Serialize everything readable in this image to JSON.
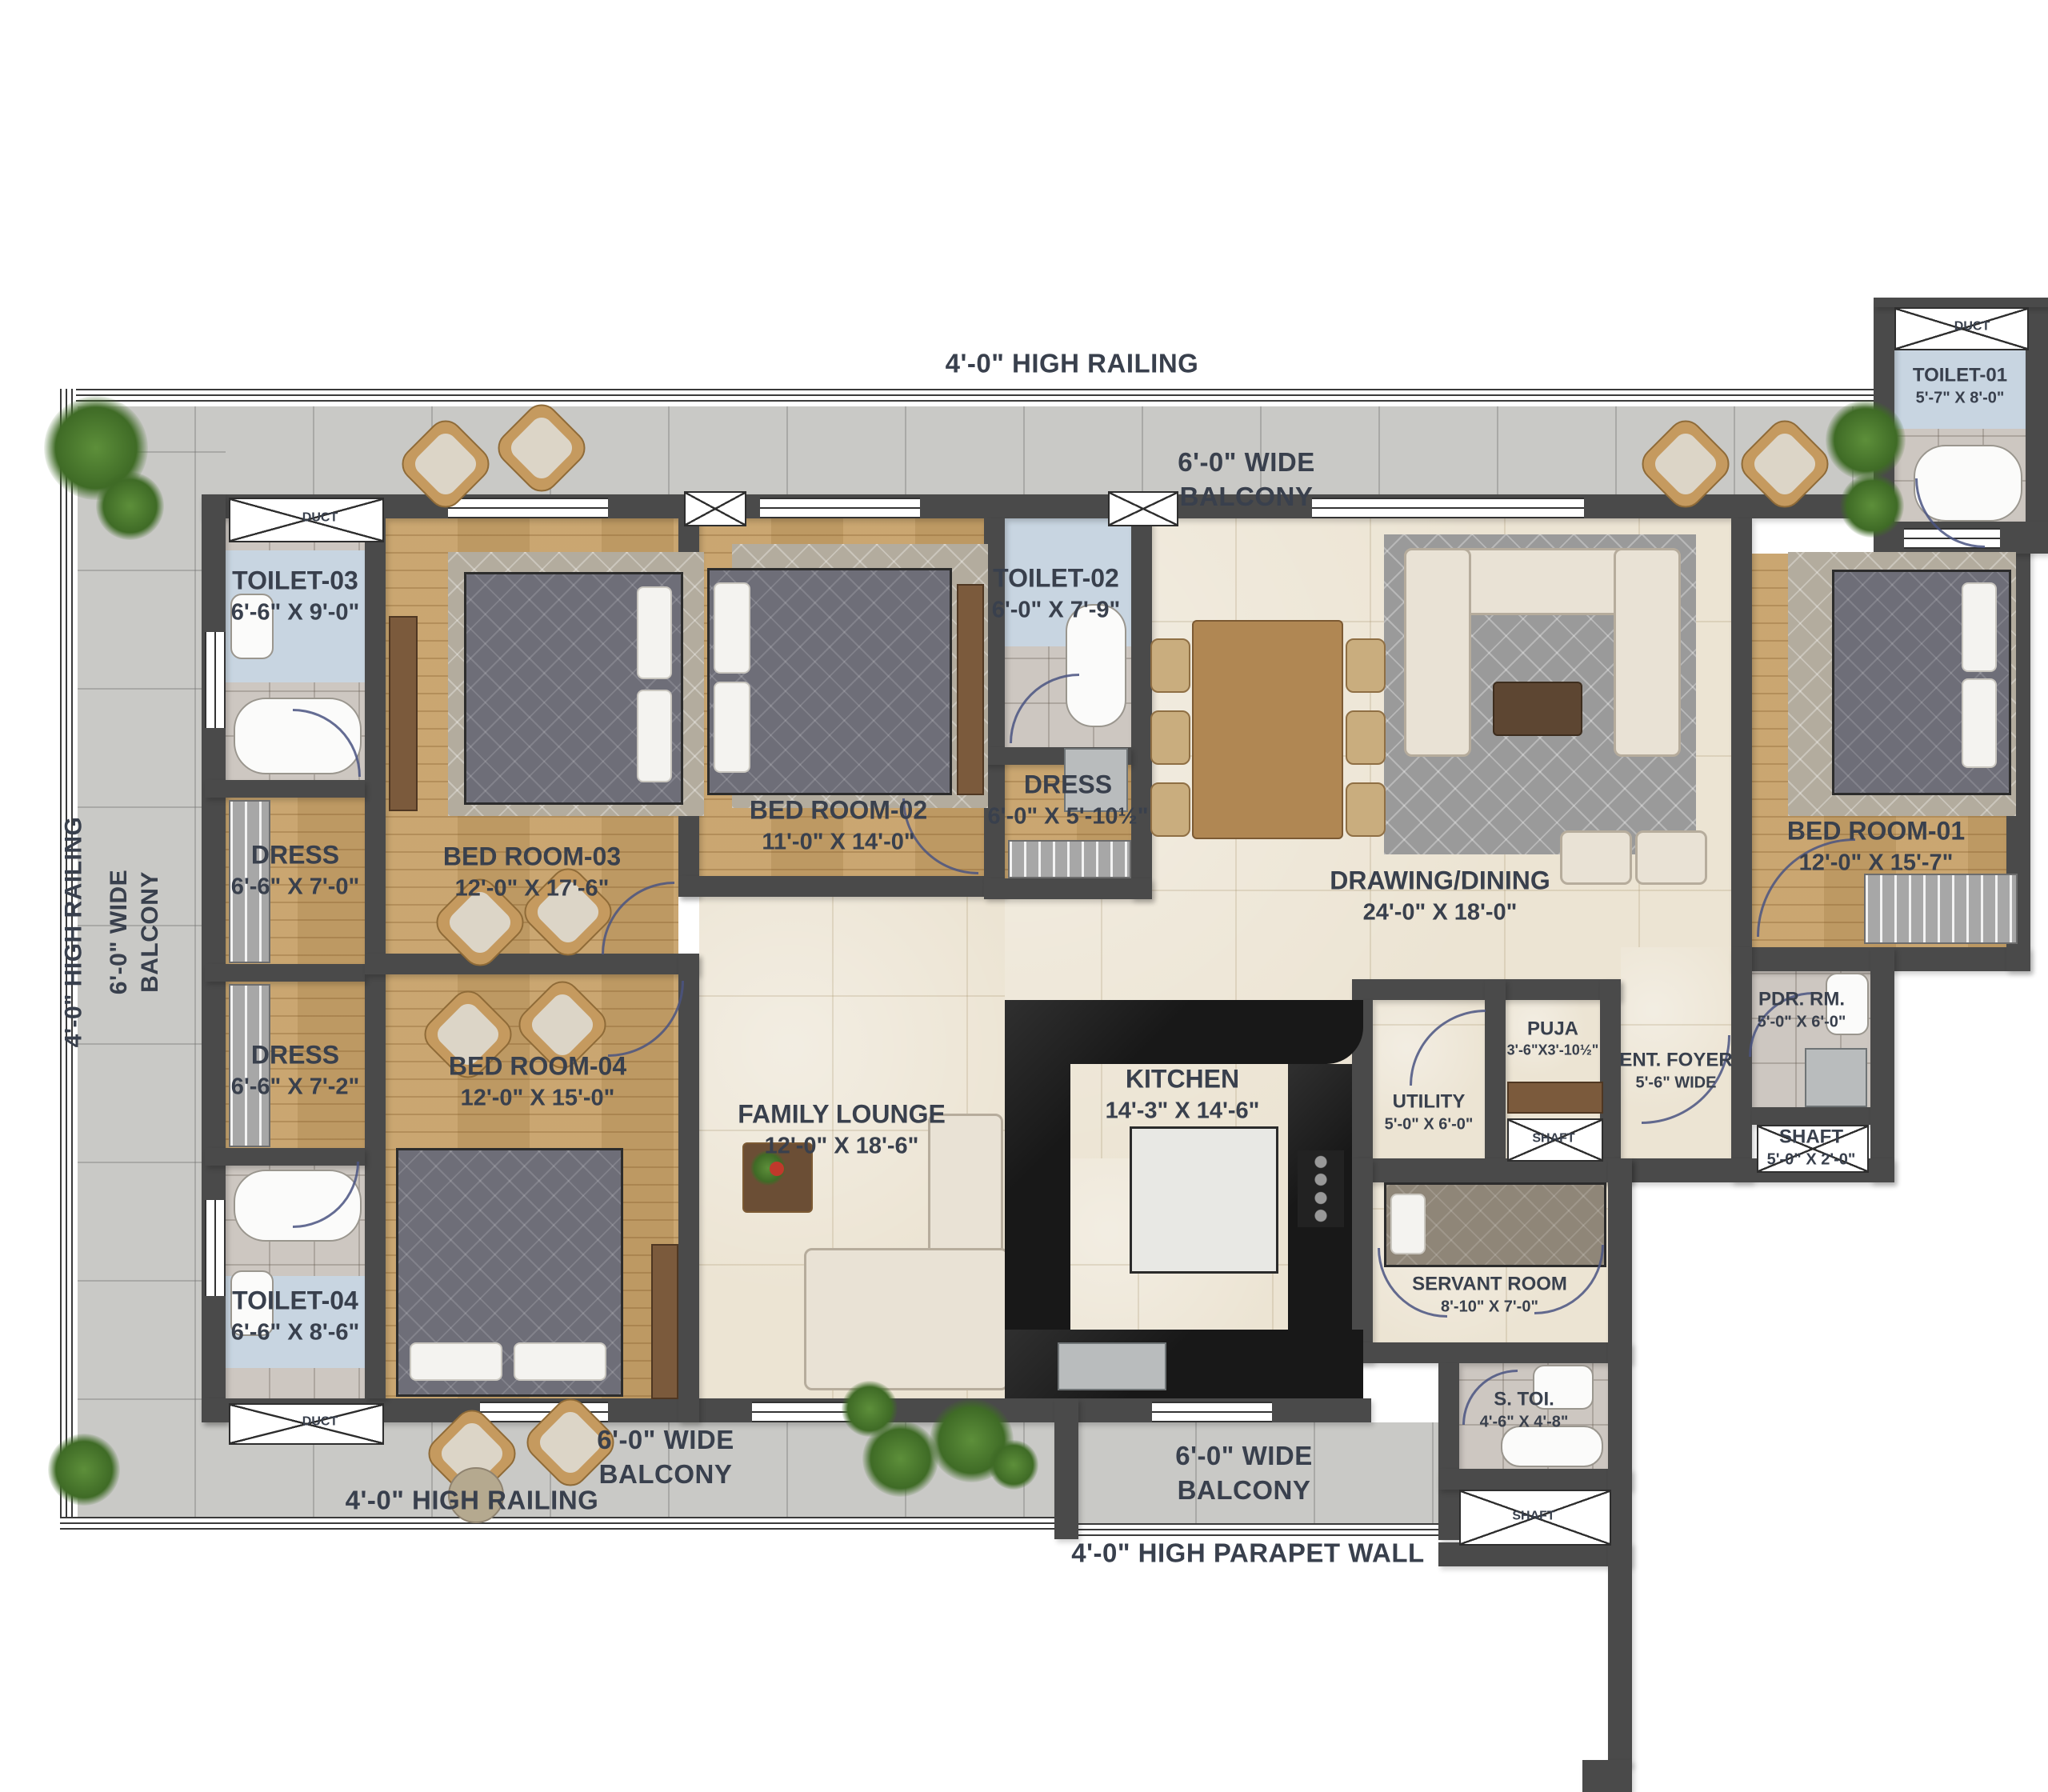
{
  "rooms": {
    "toilet_01": {
      "name": "TOILET-01",
      "dims": "5'-7\" X 8'-0\""
    },
    "toilet_02": {
      "name": "TOILET-02",
      "dims": "6'-0\" X 7'-9\""
    },
    "toilet_03": {
      "name": "TOILET-03",
      "dims": "6'-6\" X 9'-0\""
    },
    "toilet_04": {
      "name": "TOILET-04",
      "dims": "6'-6\" X 8'-6\""
    },
    "dress_1": {
      "name": "DRESS",
      "dims": "6'-6\" X 7'-0\""
    },
    "dress_2": {
      "name": "DRESS",
      "dims": "6'-6\" X 7'-2\""
    },
    "dress_mid": {
      "name": "DRESS",
      "dims": "6'-0\" X 5'-10½\""
    },
    "bedroom_01": {
      "name": "BED ROOM-01",
      "dims": "12'-0\" X 15'-7\""
    },
    "bedroom_02": {
      "name": "BED ROOM-02",
      "dims": "11'-0\" X 14'-0\""
    },
    "bedroom_03": {
      "name": "BED ROOM-03",
      "dims": "12'-0\" X 17'-6\""
    },
    "bedroom_04": {
      "name": "BED ROOM-04",
      "dims": "12'-0\" X 15'-0\""
    },
    "drawing_dining": {
      "name": "DRAWING/DINING",
      "dims": "24'-0\" X 18'-0\""
    },
    "family_lounge": {
      "name": "FAMILY  LOUNGE",
      "dims": "12'-0\" X 18'-6\""
    },
    "kitchen": {
      "name": "KITCHEN",
      "dims": "14'-3\" X 14'-6\""
    },
    "utility": {
      "name": "UTILITY",
      "dims": "5'-0\" X 6'-0\""
    },
    "puja": {
      "name": "PUJA",
      "dims": "3'-6\"X3'-10½\""
    },
    "ent_foyer": {
      "name": "ENT. FOYER",
      "dims": "5'-6\" WIDE"
    },
    "pdr_rm": {
      "name": "PDR. RM.",
      "dims": "5'-0\" X 6'-0\""
    },
    "shaft_right": {
      "name": "SHAFT",
      "dims": "5'-0\" X 2'-0\""
    },
    "servant_room": {
      "name": "SERVANT ROOM",
      "dims": "8'-10\" X 7'-0\""
    },
    "s_toi": {
      "name": "S. TOI.",
      "dims": "4'-6\" X 4'-8\""
    }
  },
  "labels": {
    "duct": "DUCT",
    "shaft": "SHAFT",
    "high_railing": "4'-0\" HIGH RAILING",
    "wide_balcony_line1": "6'-0\" WIDE",
    "wide_balcony_line2": "BALCONY",
    "parapet_wall": "4'-0\" HIGH PARAPET WALL"
  },
  "colors": {
    "wall": "#4a4a4a",
    "wood_floor": "#c7a168",
    "marble_floor": "#ece4d3",
    "tile_floor": "#cdc7c1",
    "balcony_floor": "#c9c9c6",
    "toilet_accent": "#c8d5e1",
    "label_text": "#39404d",
    "counter_black": "#181818"
  }
}
